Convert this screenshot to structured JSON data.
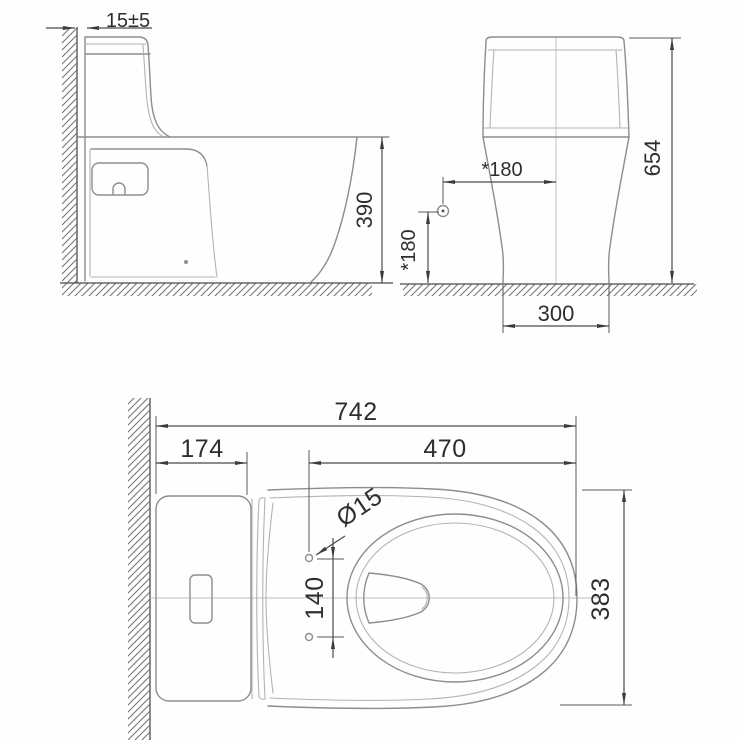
{
  "drawing": {
    "type": "technical-dimension-drawing",
    "subject": "one-piece-toilet",
    "colors": {
      "background": "#fefefe",
      "fixture_line": "#8d8d8d",
      "dimension_line": "#4a4a4a",
      "text": "#2e2e2e"
    },
    "views": {
      "side": {
        "dims": {
          "wall_gap": "15±5",
          "seat_height": "390"
        }
      },
      "front": {
        "dims": {
          "total_height": "654",
          "supply_offset": "*180",
          "supply_height": "*180",
          "base_width": "300"
        }
      },
      "top": {
        "dims": {
          "total_depth": "742",
          "tank_depth": "174",
          "bolt_to_front": "470",
          "bolt_diameter": "Ø15",
          "bolt_spacing": "140",
          "bowl_width": "383"
        }
      }
    }
  }
}
